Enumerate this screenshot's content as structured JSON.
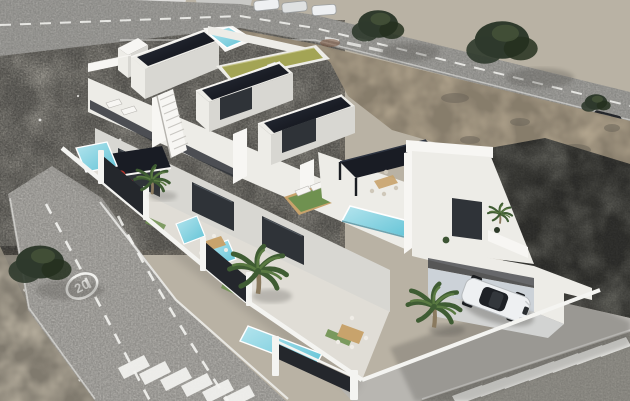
{
  "scene": {
    "description": "Aerial 3D architectural render of a row of four modern white townhouses with dark flat solar roofs, a rooftop pool, rooftop lawn terrace with pergolas, private turquoise pools, palm trees and a carport with a white car, surrounded by vacant sandy lots and roads",
    "speed_limit_marking": "20"
  },
  "objects": {
    "building": "modern-white-townhouse-row",
    "vehicle_parked": "white-sedan-in-carport",
    "road_sign": "painted-20-speed-limit",
    "pools": [
      "rooftop-pool",
      "terrace-infinity-pool",
      "yard-pool-1",
      "yard-pool-2",
      "yard-pool-3",
      "yard-pool-4"
    ],
    "vegetation": [
      "palm-trees",
      "street-trees",
      "rooftop-lawn",
      "hedges"
    ]
  },
  "palette": {
    "sand_base": "#b9b2a4",
    "rubble": "#aeaba2",
    "sand_warm": "#bcae96",
    "dirt": "#c6bdab",
    "road": "#a9a8a4",
    "road_light": "#b8b6b1",
    "road_dark": "#98968f",
    "lot_dark": "#6e6e67",
    "line_white": "#f4f4f1",
    "white_top": "#f7f6f3",
    "white_lit": "#edece7",
    "white_shade": "#d8d7d2",
    "white_dim": "#c6c5c0",
    "slab": "#191c24",
    "slab_sheen": "#2e3542",
    "glass": "#2f3338",
    "pool": "#62c3d6",
    "pool_light": "#b5e5ee",
    "lawn": "#6f9150",
    "olive": "#a3a455",
    "wood": "#c8a36c",
    "fence": "#24272c",
    "palm_dark": "#3f5c33",
    "palm_light": "#5a7a42",
    "trunk": "#8a7a5f",
    "red_accent": "#b8352b",
    "car_white": "#eef0f2",
    "car_glass": "#1e2126",
    "shadow": "#4f4d48",
    "tree_dark": "#2f3a2c",
    "interior_blue": "#ccd2d8",
    "floor_light": "#e0ddd6"
  }
}
